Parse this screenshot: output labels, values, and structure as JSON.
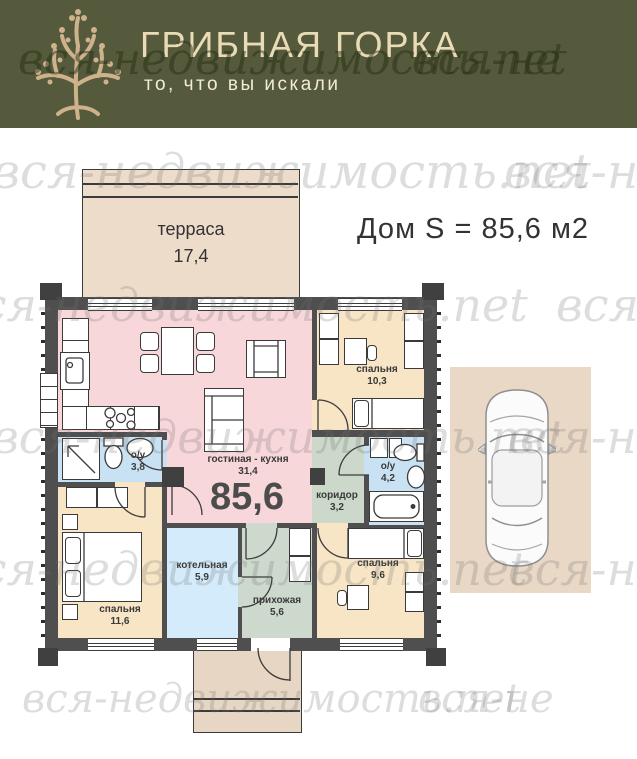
{
  "header": {
    "title": "ГРИБНАЯ ГОРКА",
    "subtitle": "то, что вы искали"
  },
  "watermark": {
    "text": "вся-недвижимость.net",
    "fragment": "вся-не"
  },
  "plan": {
    "title": "Дом S = 85,6 м2",
    "total_area": "85,6",
    "terrace": {
      "name": "терраса",
      "area": "17,4"
    },
    "rooms": {
      "living": {
        "name": "гостиная - кухня",
        "area": "31,4"
      },
      "bedroom1": {
        "name": "спальня",
        "area": "10,3"
      },
      "bedroom2": {
        "name": "спальня",
        "area": "11,6"
      },
      "bedroom3": {
        "name": "спальня",
        "area": "9,6"
      },
      "bath1": {
        "name": "о/у",
        "area": "3,8"
      },
      "bath2": {
        "name": "о/у",
        "area": "4,2"
      },
      "corridor": {
        "name": "коридор",
        "area": "3,2"
      },
      "boiler": {
        "name": "котельная",
        "area": "5,9"
      },
      "hall": {
        "name": "прихожая",
        "area": "5,6"
      }
    }
  },
  "colors": {
    "header_bg": "#545a3b",
    "header_text": "#e9dbb6",
    "logo_tan": "#cdb28c",
    "wall": "#4f4f4f",
    "living": "#f8d7da",
    "bedroom": "#f7e5c5",
    "bathroom": "#c9e2f3",
    "boiler": "#d3ebfb",
    "corridor": "#cbd8ca",
    "hall": "#cdd9cc",
    "terrace": "#eddcca",
    "porch": "#e7d6c4",
    "parking": "#e9d8c6"
  }
}
